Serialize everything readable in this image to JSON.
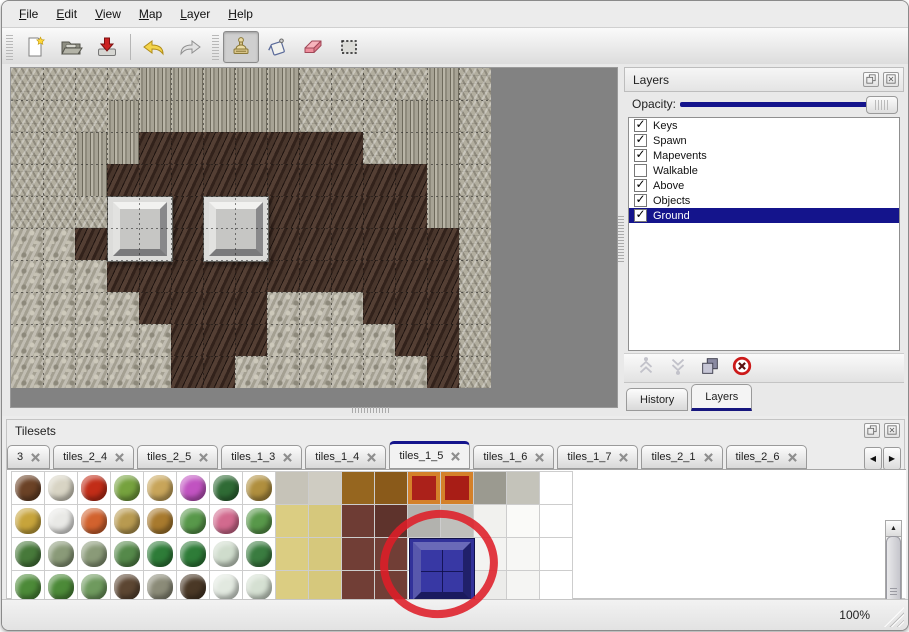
{
  "menu": {
    "items": [
      {
        "label": "File"
      },
      {
        "label": "Edit"
      },
      {
        "label": "View"
      },
      {
        "label": "Map"
      },
      {
        "label": "Layer"
      },
      {
        "label": "Help"
      }
    ]
  },
  "toolbar": {
    "buttons": [
      {
        "name": "new-file",
        "selected": false
      },
      {
        "name": "open-file",
        "selected": false
      },
      {
        "name": "save-import",
        "selected": false
      },
      {
        "name": "undo",
        "selected": false
      },
      {
        "name": "redo",
        "selected": false
      },
      {
        "name": "stamp-tool",
        "selected": true
      },
      {
        "name": "fill-tool",
        "selected": false
      },
      {
        "name": "eraser-tool",
        "selected": false
      },
      {
        "name": "select-tool",
        "selected": false
      }
    ]
  },
  "map": {
    "legend": {
      "S": "stone-scales",
      "C": "cliff-wall",
      "F": "dark-brown-floor",
      "P": "pebbles"
    },
    "grid": [
      "SSSSCCCCCSSSSCS",
      "SSSCCCCCCSSSCCS",
      "SSCCFFFFFFFSCCS",
      "SSCFFFFFFFFFFCS",
      "SSSFFFFFFFFFFCS",
      "PPFFFFFFFFFFFFS",
      "PPPFFFFFFFFFFFS",
      "PPPPFFFFPPPFFFS",
      "PPPPPFFFPPPPFFS",
      "PPPPPFFPPPPPPFS"
    ],
    "blocks": [
      {
        "name": "stone-pedestal",
        "col": 3,
        "row": 4
      },
      {
        "name": "stone-pedestal",
        "col": 6,
        "row": 4
      }
    ]
  },
  "layers_panel": {
    "title": "Layers",
    "opacity_label": "Opacity:",
    "opacity_value": 100,
    "layers": [
      {
        "name": "Keys",
        "checked": true,
        "selected": false
      },
      {
        "name": "Spawn",
        "checked": true,
        "selected": false
      },
      {
        "name": "Mapevents",
        "checked": true,
        "selected": false
      },
      {
        "name": "Walkable",
        "checked": false,
        "selected": false
      },
      {
        "name": "Above",
        "checked": true,
        "selected": false
      },
      {
        "name": "Objects",
        "checked": true,
        "selected": false
      },
      {
        "name": "Ground",
        "checked": true,
        "selected": true
      }
    ],
    "bottom_tabs": [
      {
        "label": "History",
        "active": false
      },
      {
        "label": "Layers",
        "active": true
      }
    ],
    "selection_color": "#14148c"
  },
  "tilesets_panel": {
    "title": "Tilesets",
    "tabs": [
      {
        "label": "3",
        "active": false
      },
      {
        "label": "tiles_2_4",
        "active": false
      },
      {
        "label": "tiles_2_5",
        "active": false
      },
      {
        "label": "tiles_1_3",
        "active": false
      },
      {
        "label": "tiles_1_4",
        "active": false
      },
      {
        "label": "tiles_1_5",
        "active": true
      },
      {
        "label": "tiles_1_6",
        "active": false
      },
      {
        "label": "tiles_1_7",
        "active": false
      },
      {
        "label": "tiles_2_1",
        "active": false
      },
      {
        "label": "tiles_2_6",
        "active": false
      }
    ],
    "tiles": [
      [
        "b:#6b4226",
        "b:#d8d4c4",
        "b:#c22d18",
        "b:#76a23e",
        "b:#c8a55a",
        "b:#c153c1",
        "b:#2f6b35",
        "b:#b08f3e",
        "f:#c6c3b8",
        "f:#cfccc2",
        "f:#96661f",
        "f:#8a5a1a",
        "f:#ab211a:#d4812a",
        "f:#a81d16:#d4812a",
        "f:#9b9a90",
        "f:#c4c3ba",
        "e"
      ],
      [
        "b:#c7a43b",
        "b:#e9e9e6",
        "b:#d2622e",
        "b:#b89a50",
        "b:#a87a2e",
        "b:#58984a",
        "b:#d26a8e",
        "b:#58984a",
        "f:#dbcd82",
        "f:#d6c87c",
        "f:#6e3c34",
        "f:#5e332c",
        "f:#b2b2ae",
        "f:#c0c0bc",
        "f:#f1f1ee",
        "f:#fafaf8",
        "e"
      ],
      [
        "b:#47793a",
        "b:#8a9a78",
        "b:#8a9a78",
        "b:#55894a",
        "b:#2e7c38",
        "b:#2e7c38",
        "b:#cfdccc",
        "b:#3a7c40",
        "f:#dbcd82",
        "f:#d6c87c",
        "f:#713e36",
        "f:#713e36",
        "e",
        "e",
        "f:#f3f3f1",
        "f:#f7f7f5",
        "e"
      ],
      [
        "b:#4c8a38",
        "b:#4c8a38",
        "b:#6f9a5e",
        "b:#5c4632",
        "b:#8b8b78",
        "b:#4a3826",
        "b:#e2e9e0",
        "b:#d5e0d2",
        "f:#dbcd82",
        "f:#d6c87c",
        "f:#713e36",
        "f:#713e36",
        "e",
        "e",
        "f:#ececea",
        "f:#f5f5f3",
        "e"
      ]
    ],
    "highlighted_tile": {
      "name": "blue-block-tile",
      "color": "#32329a"
    },
    "annotation": {
      "shape": "ellipse",
      "color": "#de1e28"
    }
  },
  "status_bar": {
    "zoom": "100%"
  }
}
